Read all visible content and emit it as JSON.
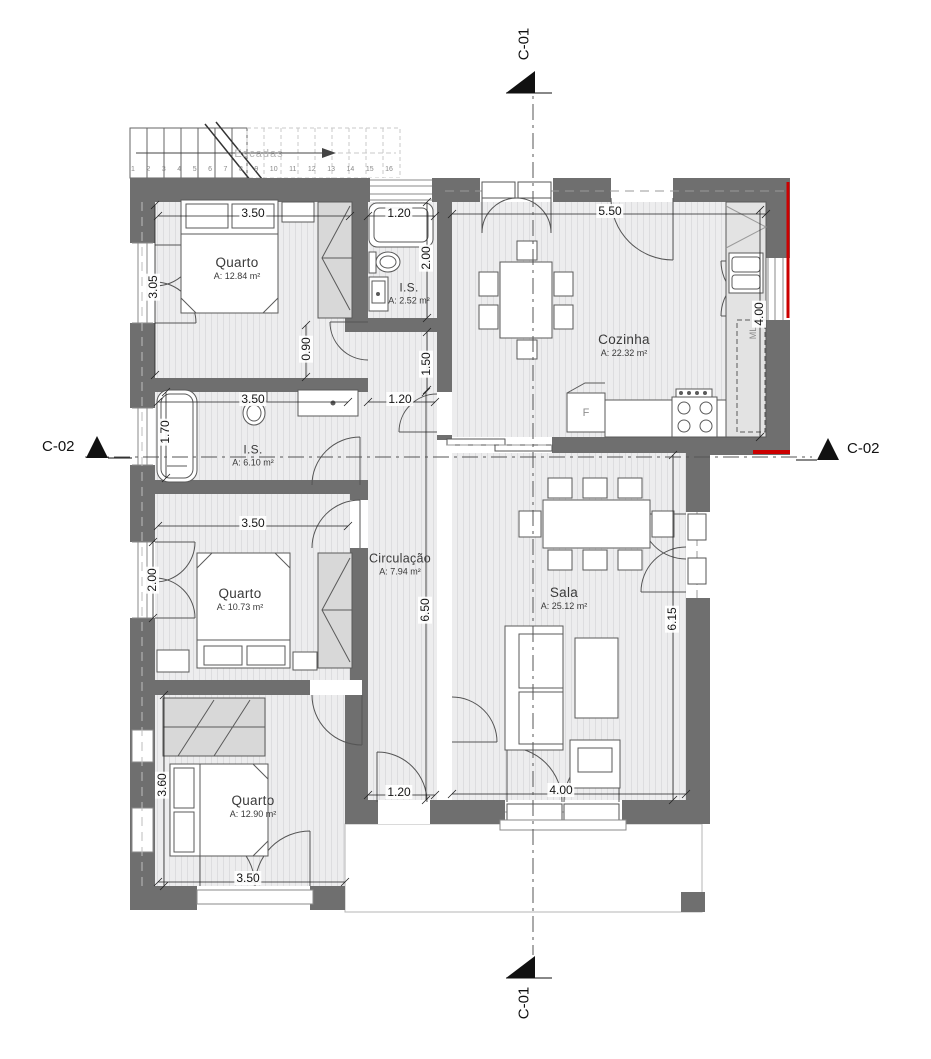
{
  "plan": {
    "markers": {
      "c01": "C-01",
      "c02": "C-02"
    },
    "stairs": {
      "label": "Escadas",
      "treads": [
        "1",
        "2",
        "3",
        "4",
        "5",
        "6",
        "7",
        "8",
        "9",
        "10",
        "11",
        "12",
        "13",
        "14",
        "15",
        "16"
      ]
    },
    "rooms": {
      "quarto1": {
        "name": "Quarto",
        "area": "A: 12.84 m²"
      },
      "is1": {
        "name": "I.S.",
        "area": "A: 2.52 m²"
      },
      "cozinha": {
        "name": "Cozinha",
        "area": "A: 22.32 m²"
      },
      "is2": {
        "name": "I.S.",
        "area": "A: 6.10 m²"
      },
      "quarto2": {
        "name": "Quarto",
        "area": "A: 10.73 m²"
      },
      "circulacao": {
        "name": "Circulação",
        "area": "A: 7.94 m²"
      },
      "sala": {
        "name": "Sala",
        "area": "A: 25.12 m²"
      },
      "quarto3": {
        "name": "Quarto",
        "area": "A: 12.90 m²"
      }
    },
    "appliances": {
      "fridge": "F",
      "washer": "ML"
    },
    "dims": {
      "quarto1_width": "3.50",
      "is1_width": "1.20",
      "cozinha_width": "5.50",
      "is1_depth": "2.00",
      "quarto1_depth": "3.05",
      "passage_quarto1": "0.90",
      "hall_top": "1.50",
      "cozinha_depth": "4.00",
      "is2_width": "3.50",
      "hall_width_top": "1.20",
      "is2_depth": "1.70",
      "quarto2_width": "3.50",
      "quarto2_window": "2.00",
      "hall_length": "6.50",
      "sala_depth": "6.15",
      "quarto3_depth": "3.60",
      "hall_width_bottom": "1.20",
      "sala_door_width": "4.00",
      "quarto3_width": "3.50"
    },
    "colors": {
      "wall": "#6f6f6f",
      "accent_red": "#cc0000"
    }
  }
}
